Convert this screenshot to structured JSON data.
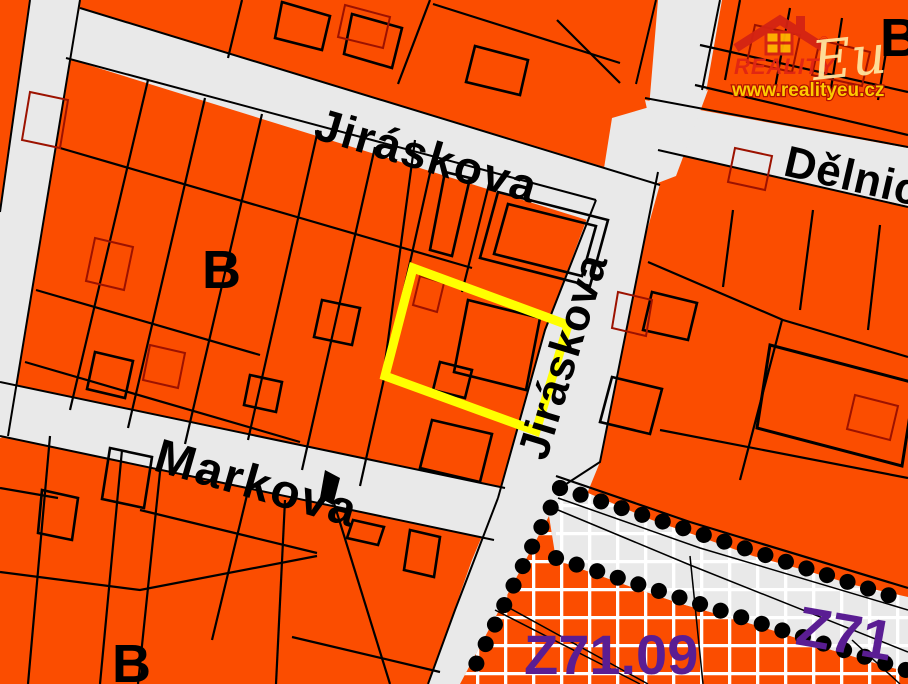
{
  "map": {
    "title": "cadastral zoning map with highlighted parcel",
    "streets": {
      "jiraskova_horizontal": "Jiráskova",
      "jiraskova_vertical": "Jiráskova",
      "markova": "Markova",
      "delnicka": "Dělnická"
    },
    "zones": {
      "b_northwest": "B",
      "b_southwest": "B",
      "b_northeast": "B",
      "z71_09": "Z71.09",
      "z71": "Z71"
    },
    "watermark": {
      "brand": "REALITY",
      "brand_script": "Eu",
      "registered": "®",
      "url": "www.realityeu.cz"
    },
    "colors": {
      "parcel_orange": "#fb4d00",
      "street_gray": "#e9e9e9",
      "boundary_black": "#000000",
      "building_red": "#9c1200",
      "highlight_yellow": "#ffff00",
      "zone_purple": "#5a1d93",
      "grid_white": "#ffffff",
      "logo_red": "#d42314",
      "logo_gold": "#ffd200"
    }
  }
}
